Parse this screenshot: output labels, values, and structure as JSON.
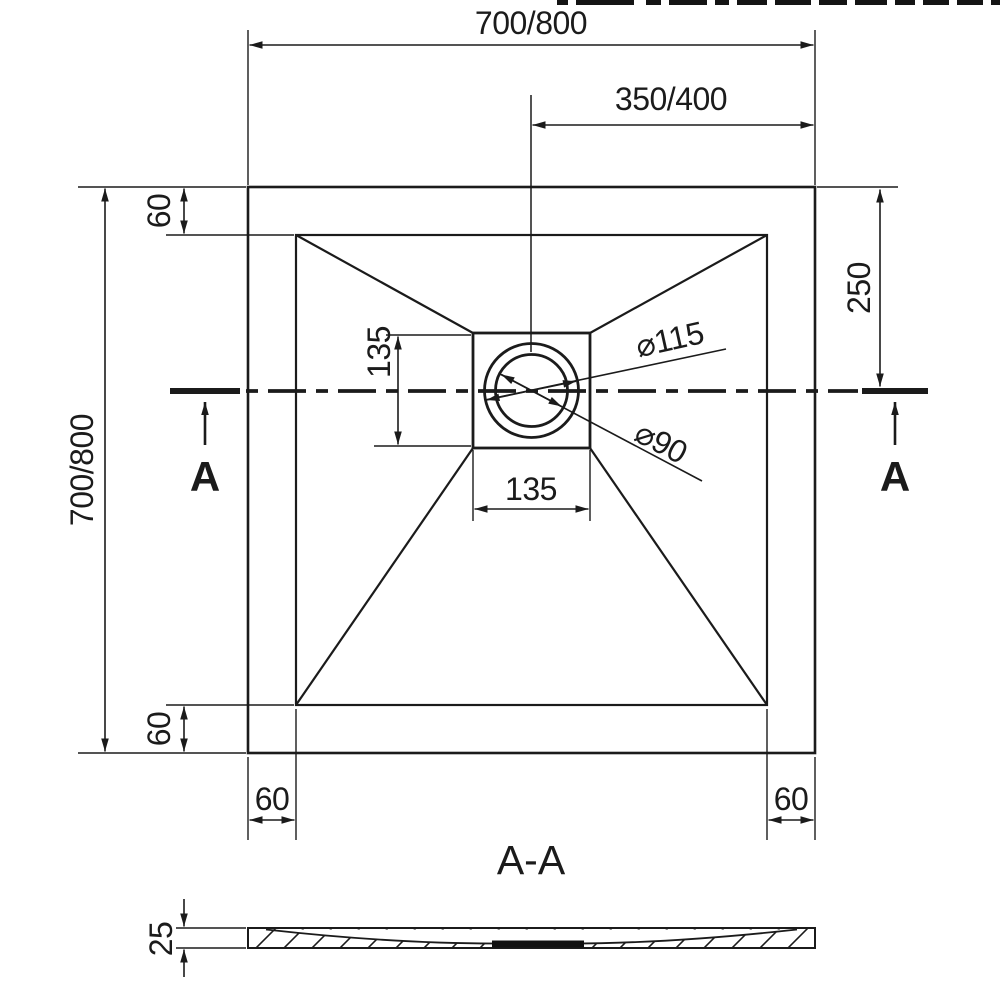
{
  "drawing": {
    "title_hint": "square shower tray dimensional drawing",
    "line_color": "#1b1b1b",
    "background_color": "#ffffff",
    "plan": {
      "dim_top_width": "700/800",
      "dim_center_to_edge": "350/400",
      "dim_left_height": "700/800",
      "dim_rim_top": "60",
      "dim_rim_bottom": "60",
      "dim_rim_left": "60",
      "dim_rim_right": "60",
      "dim_drain_from_top": "250",
      "dim_drain_square_height": "135",
      "dim_drain_square_width": "135",
      "dim_flange_diameter": "⌀115",
      "dim_waste_diameter": "⌀90",
      "section_marker_left": "A",
      "section_marker_right": "A"
    },
    "section": {
      "title": "A-A",
      "dim_thickness": "25"
    }
  }
}
